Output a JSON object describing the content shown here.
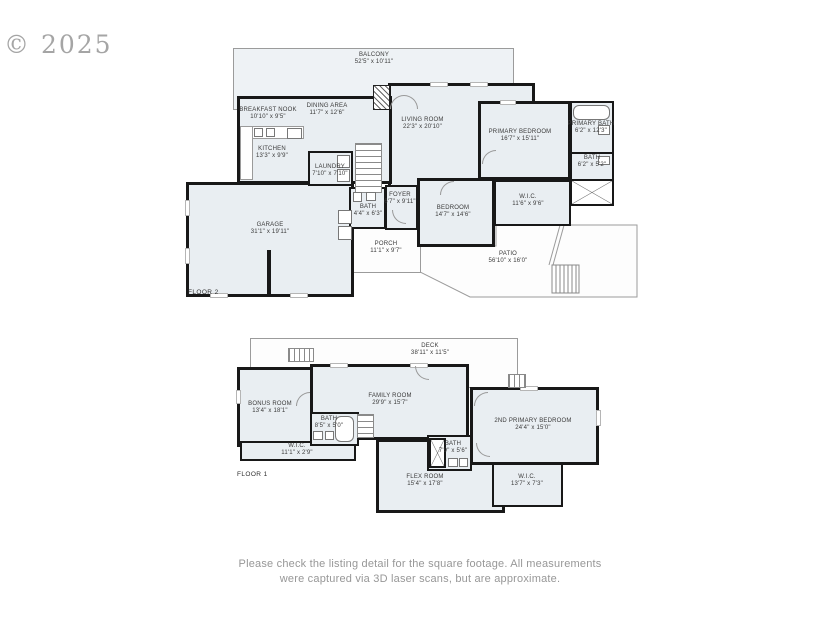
{
  "watermark": "© 2025",
  "footer": {
    "lines": [
      "Please check the listing detail for the square footage. All measurements",
      "were captured via 3D laser scans, but are approximate."
    ]
  },
  "colors": {
    "room_fill": "#e9eef2",
    "wall": "#181818",
    "outdoor_outline": "#9b9b9b"
  },
  "floor2": {
    "label": "FLOOR 2",
    "rooms": {
      "balcony": {
        "name": "BALCONY",
        "dims": "52'5\" x 10'11\""
      },
      "breakfast_nook": {
        "name": "BREAKFAST NOOK",
        "dims": "10'10\" x 9'5\""
      },
      "dining_area": {
        "name": "DINING AREA",
        "dims": "11'7\" x 12'6\""
      },
      "living_room": {
        "name": "LIVING ROOM",
        "dims": "22'3\" x 20'10\""
      },
      "kitchen": {
        "name": "KITCHEN",
        "dims": "13'3\" x 9'9\""
      },
      "laundry": {
        "name": "LAUNDRY",
        "dims": "7'10\" x 7'10\""
      },
      "primary_bedroom": {
        "name": "PRIMARY BEDROOM",
        "dims": "16'7\" x 15'11\""
      },
      "primary_bath": {
        "name": "PRIMARY BATH",
        "dims": "6'2\" x 12'3\""
      },
      "bath_right": {
        "name": "BATH",
        "dims": "6'2\" x 5'2\""
      },
      "foyer": {
        "name": "FOYER",
        "dims": "6'7\" x 9'11\""
      },
      "bath_small": {
        "name": "BATH",
        "dims": "4'4\" x 6'3\""
      },
      "bedroom": {
        "name": "BEDROOM",
        "dims": "14'7\" x 14'6\""
      },
      "wic": {
        "name": "W.I.C.",
        "dims": "11'6\" x 9'6\""
      },
      "garage": {
        "name": "GARAGE",
        "dims": "31'1\" x 19'11\""
      },
      "porch": {
        "name": "PORCH",
        "dims": "11'1\" x 9'7\""
      },
      "patio": {
        "name": "PATIO",
        "dims": "56'10\" x 16'0\""
      }
    }
  },
  "floor1": {
    "label": "FLOOR 1",
    "rooms": {
      "deck": {
        "name": "DECK",
        "dims": "38'11\" x 11'5\""
      },
      "bonus_room": {
        "name": "BONUS ROOM",
        "dims": "13'4\" x 18'1\""
      },
      "family_room": {
        "name": "FAMILY ROOM",
        "dims": "29'9\" x 15'7\""
      },
      "bath_a": {
        "name": "BATH",
        "dims": "8'5\" x 5'0\""
      },
      "wic_a": {
        "name": "W.I.C.",
        "dims": "11'1\" x 2'9\""
      },
      "second_primary_bedroom": {
        "name": "2ND PRIMARY BEDROOM",
        "dims": "24'4\" x 15'0\""
      },
      "bath_b": {
        "name": "BATH",
        "dims": "7'9\" x 5'6\""
      },
      "flex_room": {
        "name": "FLEX ROOM",
        "dims": "15'4\" x 17'8\""
      },
      "wic_b": {
        "name": "W.I.C.",
        "dims": "13'7\" x 7'3\""
      }
    }
  }
}
